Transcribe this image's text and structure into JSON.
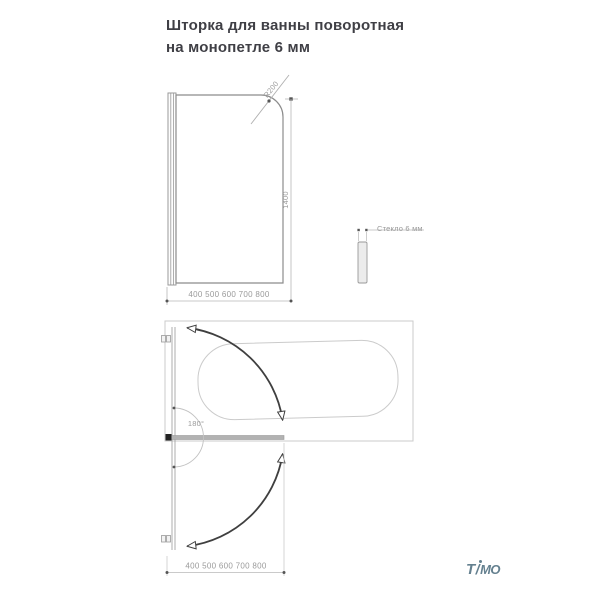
{
  "title": {
    "line1": "Шторка для ванны поворотная",
    "line2": "на монопетле 6 мм"
  },
  "front_view": {
    "radius_label": "R200",
    "height_label": "1400",
    "width_range_label": "400 500 600 700 800"
  },
  "side_view": {
    "glass_thickness_label": "Стекло 6 мм"
  },
  "top_view": {
    "rotation_angle_label": "180°",
    "width_range_label": "400 500 600 700 800"
  },
  "logo": {
    "t": "T",
    "slash": "/",
    "mo": "MO"
  },
  "colors": {
    "title_text": "#3f3f45",
    "dimension_text": "#9a9a9a",
    "drawing_line": "#9a9a9a",
    "light_line": "#cbcbcb",
    "arrow": "#3f3f3f",
    "bar_fill": "#b2b2b2",
    "logo": "#64808f"
  }
}
